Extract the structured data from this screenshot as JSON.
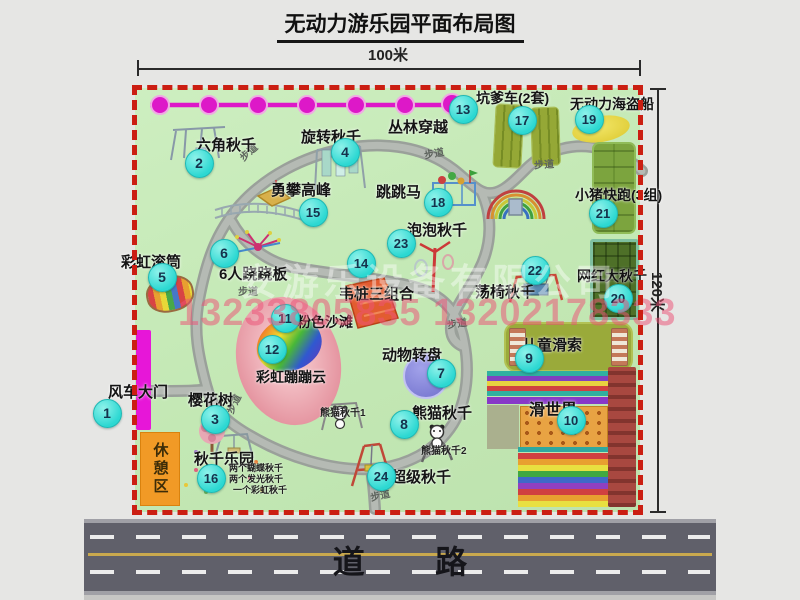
{
  "title": "无动力游乐园平面布局图",
  "dimensions": {
    "width": "100米",
    "height": "120米"
  },
  "road": {
    "label": "道路"
  },
  "watermark": {
    "company": "安游乐设备有限公司",
    "phones": "13233805835 13202178333"
  },
  "rest_area_label": "休憩区",
  "attractions": [
    {
      "n": "1",
      "label": "风车大门",
      "bx": 106,
      "by": 412,
      "lx": 108,
      "ly": 381,
      "fs": 15
    },
    {
      "n": "2",
      "label": "六角秋千",
      "bx": 198,
      "by": 162,
      "lx": 196,
      "ly": 134,
      "fs": 15
    },
    {
      "n": "3",
      "label": "樱花树",
      "bx": 214,
      "by": 418,
      "lx": 188,
      "ly": 389,
      "fs": 15
    },
    {
      "n": "4",
      "label": "旋转秋千",
      "bx": 344,
      "by": 151,
      "lx": 301,
      "ly": 126,
      "fs": 15
    },
    {
      "n": "5",
      "label": "彩虹滚筒",
      "bx": 161,
      "by": 276,
      "lx": 121,
      "ly": 251,
      "fs": 15
    },
    {
      "n": "6",
      "label": "6人跷跷板",
      "bx": 223,
      "by": 252,
      "lx": 219,
      "ly": 263,
      "fs": 15
    },
    {
      "n": "7",
      "label": "动物转盘",
      "bx": 440,
      "by": 372,
      "lx": 382,
      "ly": 344,
      "fs": 15
    },
    {
      "n": "8",
      "label": "熊猫秋千",
      "bx": 403,
      "by": 423,
      "lx": 412,
      "ly": 402,
      "fs": 15
    },
    {
      "n": "9",
      "label": "儿童滑索",
      "bx": 528,
      "by": 357,
      "lx": 522,
      "ly": 334,
      "fs": 15
    },
    {
      "n": "10",
      "label": "滑世界",
      "bx": 570,
      "by": 419,
      "lx": 529,
      "ly": 396,
      "fs": 16
    },
    {
      "n": "11",
      "label": "粉色沙滩",
      "bx": 284,
      "by": 317,
      "lx": 297,
      "ly": 312,
      "fs": 14
    },
    {
      "n": "12",
      "label": "彩虹蹦蹦云",
      "bx": 271,
      "by": 348,
      "lx": 256,
      "ly": 367,
      "fs": 14
    },
    {
      "n": "13",
      "label": "丛林穿越",
      "bx": 462,
      "by": 108,
      "lx": 388,
      "ly": 116,
      "fs": 15
    },
    {
      "n": "14",
      "label": "韦桩三组合",
      "bx": 360,
      "by": 262,
      "lx": 339,
      "ly": 283,
      "fs": 15
    },
    {
      "n": "15",
      "label": "勇攀高峰",
      "bx": 312,
      "by": 211,
      "lx": 271,
      "ly": 179,
      "fs": 15
    },
    {
      "n": "16",
      "label": "秋千乐园",
      "bx": 210,
      "by": 477,
      "lx": 194,
      "ly": 448,
      "fs": 15
    },
    {
      "n": "17",
      "label": "坑爹车(2套)",
      "bx": 521,
      "by": 119,
      "lx": 476,
      "ly": 88,
      "fs": 14
    },
    {
      "n": "18",
      "label": "跳跳马",
      "bx": 437,
      "by": 201,
      "lx": 376,
      "ly": 181,
      "fs": 15
    },
    {
      "n": "19",
      "label": "无动力海盗船",
      "bx": 588,
      "by": 118,
      "lx": 570,
      "ly": 94,
      "fs": 14
    },
    {
      "n": "20",
      "label": "网红大秋千",
      "bx": 617,
      "by": 297,
      "lx": 577,
      "ly": 266,
      "fs": 14
    },
    {
      "n": "21",
      "label": "小猪快跑(3组)",
      "bx": 602,
      "by": 212,
      "lx": 575,
      "ly": 185,
      "fs": 14
    },
    {
      "n": "22",
      "label": "荡椅秋千",
      "bx": 534,
      "by": 269,
      "lx": 475,
      "ly": 281,
      "fs": 15
    },
    {
      "n": "23",
      "label": "泡泡秋千",
      "bx": 400,
      "by": 242,
      "lx": 407,
      "ly": 219,
      "fs": 15
    },
    {
      "n": "24",
      "label": "超级秋千",
      "bx": 380,
      "by": 475,
      "lx": 391,
      "ly": 466,
      "fs": 15
    }
  ],
  "sub_labels": [
    {
      "text": "熊猫秋千1",
      "x": 320,
      "y": 404,
      "fs": 10
    },
    {
      "text": "熊猫秋千2",
      "x": 421,
      "y": 442,
      "fs": 10
    },
    {
      "text": "两个蝴蝶秋千",
      "x": 229,
      "y": 461,
      "fs": 9
    },
    {
      "text": "两个发光秋千",
      "x": 229,
      "y": 472,
      "fs": 9
    },
    {
      "text": "一个彩虹秋千",
      "x": 233,
      "y": 483,
      "fs": 9
    }
  ],
  "path_labels": [
    {
      "text": "步道",
      "x": 238,
      "y": 144,
      "rot": -42
    },
    {
      "text": "步道",
      "x": 424,
      "y": 145,
      "rot": -10
    },
    {
      "text": "步道",
      "x": 534,
      "y": 156,
      "rot": -4
    },
    {
      "text": "步道",
      "x": 238,
      "y": 283,
      "rot": 0
    },
    {
      "text": "步道",
      "x": 447,
      "y": 315,
      "rot": -8
    },
    {
      "text": "步道",
      "x": 223,
      "y": 396,
      "rot": -64
    },
    {
      "text": "步道",
      "x": 370,
      "y": 487,
      "rot": -12
    }
  ]
}
